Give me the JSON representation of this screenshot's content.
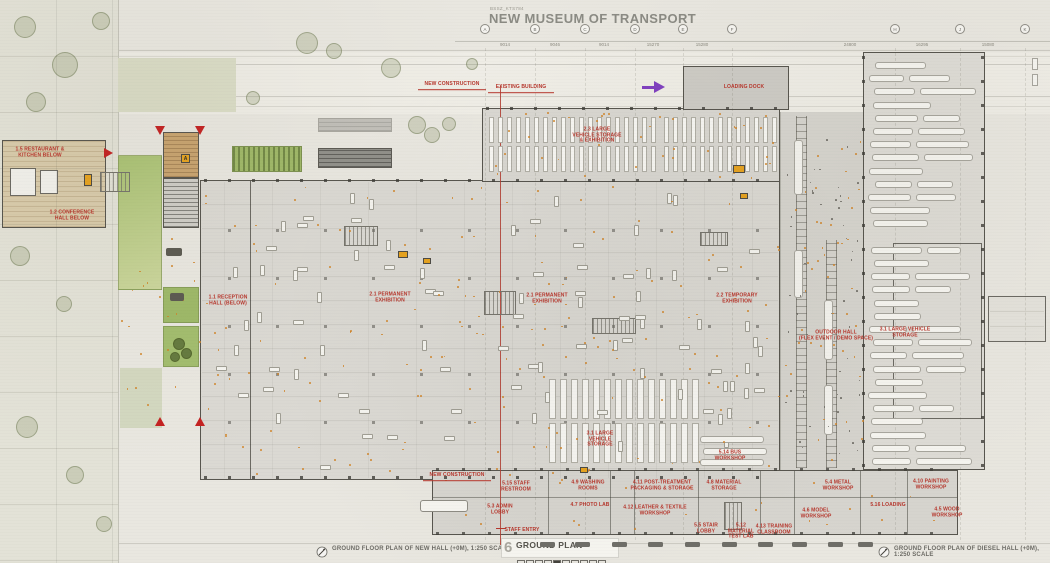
{
  "header": {
    "project_code": "BSSZ_KTS784",
    "title": "NEW MUSEUM OF TRANSPORT"
  },
  "grid": {
    "bubbles": [
      {
        "label": "A",
        "x": 480
      },
      {
        "label": "B",
        "x": 530
      },
      {
        "label": "C",
        "x": 580
      },
      {
        "label": "D",
        "x": 630
      },
      {
        "label": "E",
        "x": 678
      },
      {
        "label": "F",
        "x": 727
      },
      {
        "label": "H",
        "x": 890
      },
      {
        "label": "J",
        "x": 955
      },
      {
        "label": "K",
        "x": 1020
      }
    ],
    "dims": [
      {
        "text": "9014",
        "x": 505
      },
      {
        "text": "9046",
        "x": 555
      },
      {
        "text": "9014",
        "x": 604
      },
      {
        "text": "15270",
        "x": 653
      },
      {
        "text": "15280",
        "x": 702
      },
      {
        "text": "24800",
        "x": 850
      },
      {
        "text": "16295",
        "x": 922
      },
      {
        "text": "15080",
        "x": 988
      }
    ]
  },
  "room_labels": [
    {
      "text": "1.5 RESTAURANT &\nKITCHEN BELOW",
      "x": 40,
      "y": 153,
      "w": 64
    },
    {
      "text": "1.2 CONFERENCE\nHALL BELOW",
      "x": 72,
      "y": 216,
      "w": 60
    },
    {
      "text": "1.1 RECEPTION\nHALL (BELOW)",
      "x": 228,
      "y": 301,
      "w": 54
    },
    {
      "text": "2.1 PERMANENT\nEXHIBITION",
      "x": 390,
      "y": 298,
      "w": 56
    },
    {
      "text": "2.1 PERMANENT\nEXHIBITION",
      "x": 547,
      "y": 299,
      "w": 56
    },
    {
      "text": "2.2 TEMPORARY\nEXHIBITION",
      "x": 737,
      "y": 299,
      "w": 56
    },
    {
      "text": "2.3 LARGE\nVEHICLE STORAGE\n& EXHIBITION",
      "x": 597,
      "y": 136,
      "w": 62
    },
    {
      "text": "LOADING DOCK",
      "x": 744,
      "y": 88,
      "w": 56
    },
    {
      "text": "OUTDOOR HALL\n(FLEX EVENT / DEMO SPACE)",
      "x": 836,
      "y": 336,
      "w": 84
    },
    {
      "text": "3.1 LARGE VEHICLE\nSTORAGE",
      "x": 905,
      "y": 333,
      "w": 70
    },
    {
      "text": "3.1 LARGE\nVEHICLE\nSTORAGE",
      "x": 600,
      "y": 440,
      "w": 44
    },
    {
      "text": "5.14 BUS\nWORKSHOP",
      "x": 730,
      "y": 456,
      "w": 44
    },
    {
      "text": "5.15 STAFF\nRESTROOM",
      "x": 516,
      "y": 487,
      "w": 44
    },
    {
      "text": "4.9 WASHING\nROOMS",
      "x": 588,
      "y": 486,
      "w": 48
    },
    {
      "text": "4.11 POST-TREATMENT\nPACKAGING & STORAGE",
      "x": 662,
      "y": 486,
      "w": 76
    },
    {
      "text": "4.8 MATERIAL\nSTORAGE",
      "x": 724,
      "y": 486,
      "w": 48
    },
    {
      "text": "5.4 METAL\nWORKSHOP",
      "x": 838,
      "y": 486,
      "w": 44
    },
    {
      "text": "4.10 PAINTING\nWORKSHOP",
      "x": 931,
      "y": 485,
      "w": 52
    },
    {
      "text": "5.3 ADMIN\nLOBBY",
      "x": 500,
      "y": 510,
      "w": 40
    },
    {
      "text": "4.7 PHOTO LAB",
      "x": 590,
      "y": 506,
      "w": 50
    },
    {
      "text": "4.12 LEATHER & TEXTILE\nWORKSHOP",
      "x": 655,
      "y": 511,
      "w": 82
    },
    {
      "text": "4.6 MODEL\nWORKSHOP",
      "x": 816,
      "y": 514,
      "w": 44
    },
    {
      "text": "5.16 LOADING",
      "x": 888,
      "y": 506,
      "w": 46
    },
    {
      "text": "4.5 WOOD\nWORKSHOP",
      "x": 947,
      "y": 513,
      "w": 44
    },
    {
      "text": "5.5 STAIR\nLOBBY",
      "x": 706,
      "y": 529,
      "w": 36
    },
    {
      "text": "5.12\nMATERIAL\nTEST LAB",
      "x": 741,
      "y": 532,
      "w": 36
    },
    {
      "text": "4.13 TRAINING\nCLASSROOM",
      "x": 774,
      "y": 530,
      "w": 50
    },
    {
      "text": "NEW CONSTRUCTION",
      "x": 452,
      "y": 86,
      "w": 68,
      "style": "callout"
    },
    {
      "text": "EXISTING BUILDING",
      "x": 521,
      "y": 89,
      "w": 66,
      "style": "callout"
    },
    {
      "text": "NEW CONSTRUCTION",
      "x": 457,
      "y": 477,
      "w": 68,
      "style": "callout"
    },
    {
      "text": "STAFF ENTRY",
      "x": 522,
      "y": 531,
      "w": 50
    }
  ],
  "markers": {
    "elevator_letter": "A"
  },
  "footer": {
    "left_caption": "GROUND FLOOR PLAN OF NEW HALL (+0M), 1:250 SCALE",
    "center_number": "6",
    "center_title": "GROUND PLAN",
    "right_caption": "GROUND FLOOR PLAN OF DIESEL HALL (+0M), 1:250 SCALE"
  },
  "colors": {
    "label_red": "#b5362c",
    "accent_orange": "#e7a31f",
    "scatter_orange": "#d08428",
    "arrow_purple": "#8040c0",
    "wall": "#57554e"
  }
}
